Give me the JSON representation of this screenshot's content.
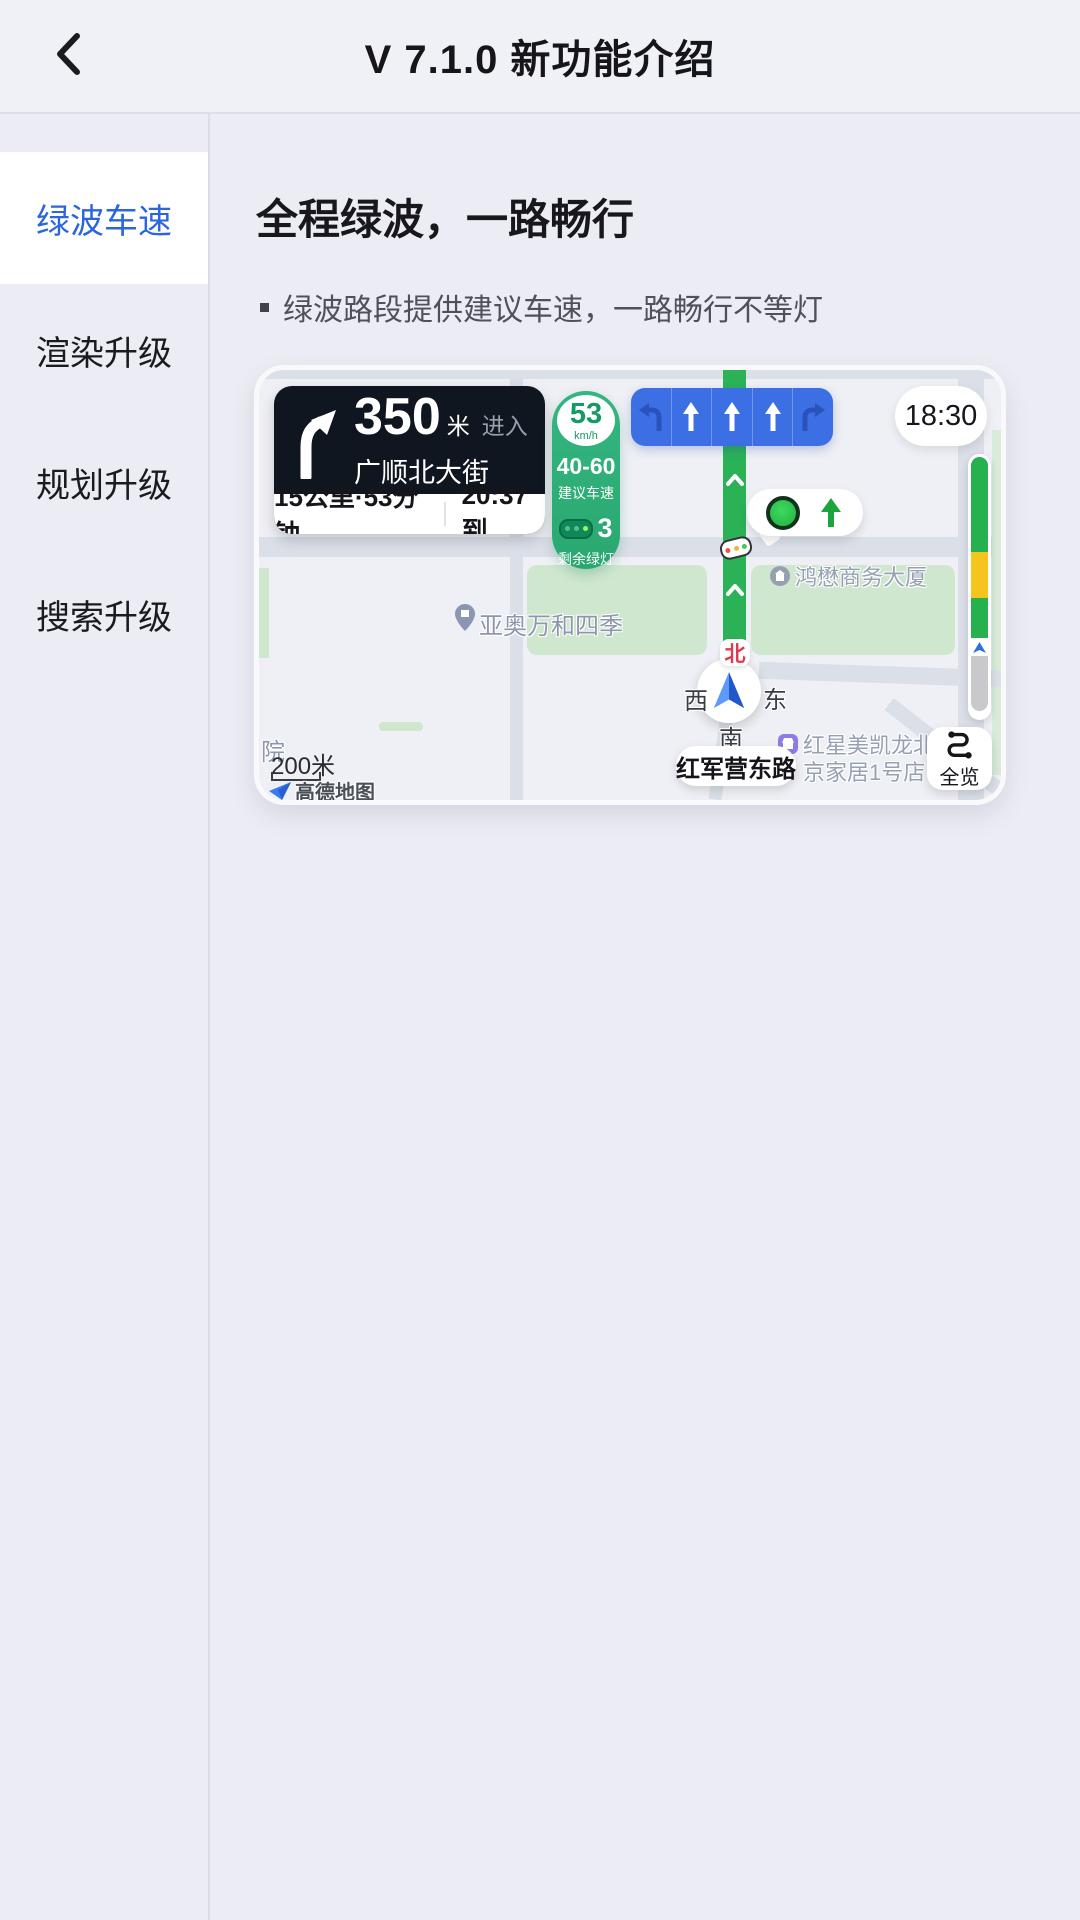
{
  "header": {
    "title": "V 7.1.0 新功能介绍"
  },
  "sidebar": {
    "items": [
      {
        "label": "绿波车速",
        "active": true
      },
      {
        "label": "渲染升级",
        "active": false
      },
      {
        "label": "规划升级",
        "active": false
      },
      {
        "label": "搜索升级",
        "active": false
      }
    ]
  },
  "content": {
    "title": "全程绿波，一路畅行",
    "bullet": "绿波路段提供建议车速，一路畅行不等灯"
  },
  "map": {
    "nav_card": {
      "distance": "350",
      "unit": "米",
      "action": "进入",
      "road": "广顺北大街",
      "trip": "15公里·53分钟",
      "eta": "20:37到"
    },
    "speed": {
      "value": "53",
      "unit": "km/h",
      "range": "40-60",
      "range_label": "建议车速",
      "lights": "3",
      "lights_label": "剩余绿灯"
    },
    "clock": "18:30",
    "labels": {
      "building": "鸿懋商务大厦",
      "complex": "亚奥万和四季",
      "store1": "红星美凯龙北",
      "store2": "京家居1号店",
      "road": "红军营东路",
      "partial": "院"
    },
    "compass": {
      "n": "北",
      "w": "西",
      "e": "东",
      "s": "南"
    },
    "overview": "全览",
    "scale": "200米",
    "logo": "高德地图",
    "colors": {
      "accent_blue": "#2B66E0",
      "speed_green": "#2FAD79",
      "route_green": "#2BB257",
      "lane_blue": "#3D6FE4",
      "bar_green": "#25B14D",
      "bar_yellow": "#F4C51D",
      "bar_gray": "#C9C9CD"
    }
  }
}
